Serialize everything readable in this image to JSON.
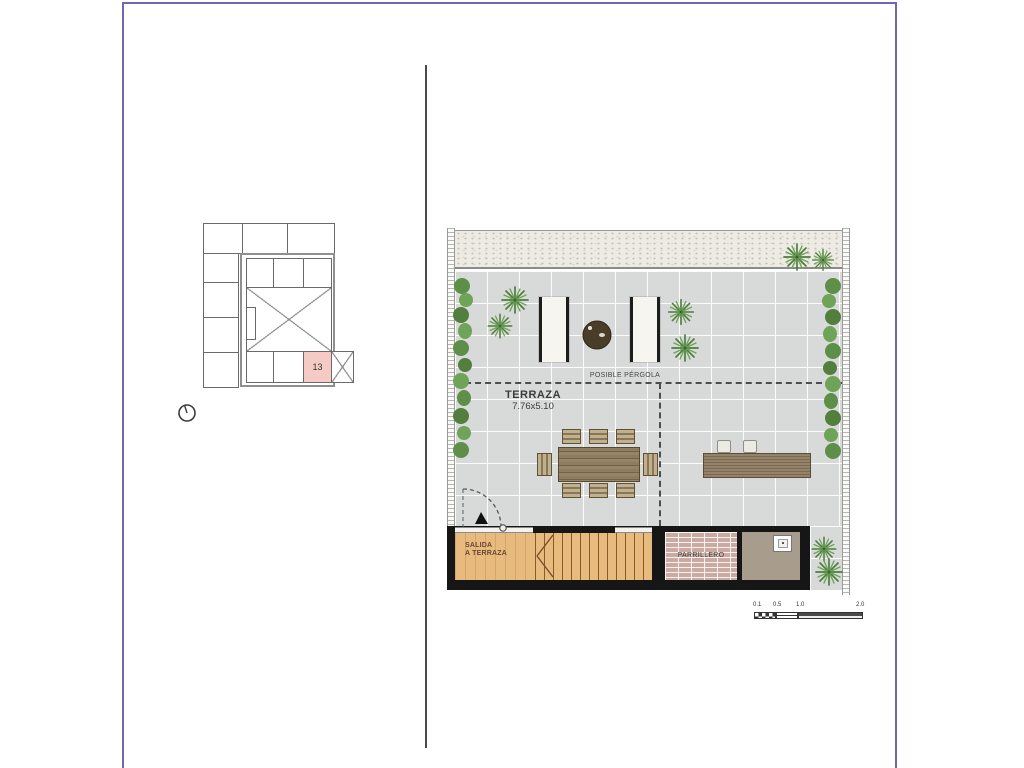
{
  "window": {
    "frame_border_color": "#7265b2",
    "background": "#ffffff"
  },
  "key_plan": {
    "highlighted_unit": "13",
    "highlight_color": "#f6cbc6"
  },
  "floor_plan": {
    "terraza_label": "TERRAZA",
    "terraza_dimensions": "7.76x5.10",
    "pergola_label": "POSIBLE PÉRGOLA",
    "salida_line1": "SALIDA",
    "salida_line2": "A TERRAZA",
    "parrillero_label": "PARRILLERO"
  },
  "scale_bar": {
    "labels": [
      "0.1",
      "0.5",
      "1.0",
      "2.0"
    ]
  },
  "palette": {
    "tile": "#d8dad9",
    "wood": "#e7ba7e",
    "wall_black": "#161616",
    "plant_green": "#5e924a",
    "furniture_brown": "#82714f",
    "brick": "#cbaaa2"
  }
}
